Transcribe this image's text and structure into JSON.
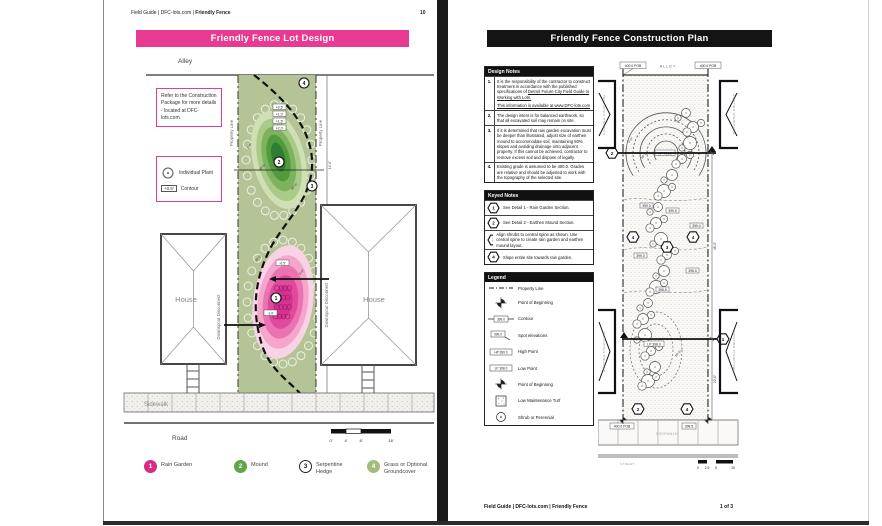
{
  "colors": {
    "accent_pink": "#e83a90",
    "lot_green": "#b5c496",
    "mound_green": "#5fa644",
    "rain_pink": "#d92a84",
    "banner_black": "#141414"
  },
  "page_left": {
    "header": {
      "breadcrumb_prefix": "Field Guide | DFC-lots.com | ",
      "breadcrumb_bold": "Friendly Fence",
      "page_num": "10"
    },
    "title": "Friendly Fence Lot Design",
    "note_box": "Refer to the Construction Package for more details - located at DFC-lots.com.",
    "key_box": {
      "plant": "Individual Plant",
      "contour_tag": "+0.5'",
      "contour": "Contour"
    },
    "labels": {
      "alley": "Alley",
      "property_line": "Property Line",
      "house": "House",
      "downspout": "Downspout Disconnect",
      "sidewalk": "Sidewalk",
      "road": "Road"
    },
    "mound_contours": [
      "+0.5'",
      "+1.0'",
      "+1.5'",
      "+2.0'"
    ],
    "rain_contours": [
      "-0.5'",
      "-1.0'"
    ],
    "markers": {
      "m1": "1",
      "m2": "2",
      "m3": "3",
      "m4": "4"
    },
    "dims": {
      "d1": "1'-0\"",
      "d2": "10'-0\"",
      "d3": "10'-0\"",
      "d4": "10'-0\"",
      "d5": "1'-0\"",
      "d6": "14'-0\"",
      "d7": "37'-0\""
    },
    "scale_ticks": [
      "0'",
      "4'",
      "8'",
      "16'"
    ],
    "legend": [
      {
        "num": "1",
        "label": "Rain Garden",
        "color": "#d92a84"
      },
      {
        "num": "2",
        "label": "Mound",
        "color": "#5fa644"
      },
      {
        "num": "3",
        "label": "Serpentine Hedge",
        "color": "#ffffff"
      },
      {
        "num": "4",
        "label": "Grass or Optional Groundcover",
        "color": "#a3bd7f"
      }
    ]
  },
  "page_right": {
    "title": "Friendly Fence Construction Plan",
    "design_notes": {
      "header": "Design Notes",
      "items": [
        {
          "num": "1.",
          "text1": "It is the responsibility of the contractor to construct treatment in accordance with the published specifications of ",
          "link": "Detroit Future City Field Guide to Working with Lots.",
          "text2": "This information is available at www.DFC-lots.com"
        },
        {
          "num": "2.",
          "text": "The design intent is for balanced earthwork, so that all excavated soil may remain on site."
        },
        {
          "num": "3.",
          "text": "If it is determined that rain garden excavation must be deeper than illustrated, adjust size of earthen mound to accommodate soil, maintaining 50% slopes and avoiding drainage onto adjacent property. If this cannot be achieved, contractor to remove excess soil and dispose of legally."
        },
        {
          "num": "4.",
          "text": "Existing grade is assumed to be 400.0. Grades are relative and should be adjusted to work with the topography of the selected site."
        }
      ]
    },
    "keyed_notes": {
      "header": "Keyed Notes",
      "items": [
        {
          "num": "1",
          "text": "See Detail 1 - Rain Garden Section."
        },
        {
          "num": "2",
          "text": "See Detail 2 - Earthen Mound Section."
        },
        {
          "num": "3",
          "text": "Align shrubs to central spine as shown. Use central spine to create rain garden and earthen mound layout."
        },
        {
          "num": "4",
          "text": "Slope entire site towards rain garden."
        }
      ]
    },
    "legend": {
      "header": "Legend",
      "items": [
        {
          "label": "Property Line"
        },
        {
          "label": "Point of Beginning"
        },
        {
          "label": "Contour",
          "tag": "399.0"
        },
        {
          "label": "Spot elevations",
          "tag": "399.0"
        },
        {
          "label": "High Point",
          "tag": "HP 399.0"
        },
        {
          "label": "Low Point",
          "tag": "LP 398.0"
        },
        {
          "label": "Point of Beginning"
        },
        {
          "label": "Low Maintenance Turf"
        },
        {
          "label": "Shrub or Perennial"
        }
      ]
    },
    "plan": {
      "alley": "ALLEY",
      "sidewalk": "SIDEWALK",
      "street": "STREET",
      "existing_structure": "EXISTING STRUCTURE",
      "pob_top_left": "400.0 POB",
      "pob_top_right": "400.0 POB",
      "pob_bottom": "400.0 POB",
      "spot_bottom": "398.5",
      "hp": "HP 401.0",
      "lp": "LP 398.0",
      "spots": [
        "399.5",
        "399.5",
        "399.0",
        "399.0",
        "398.5",
        "398.5"
      ],
      "dim_upper": "48'-0\"",
      "dim_lower": "22'-0\"",
      "diag_dims": [
        "1'-0\"",
        "10'-0\"",
        "10'-0\""
      ],
      "hex": {
        "h1": "1",
        "h2": "2",
        "h3": "3",
        "h4": "4"
      },
      "scale_ticks": [
        "0",
        "2.5",
        "5",
        "10"
      ]
    },
    "footer": {
      "breadcrumb_prefix": "Field Guide | DFC-lots.com | ",
      "breadcrumb_bold": "Friendly Fence",
      "page_num": "1 of 3"
    }
  }
}
